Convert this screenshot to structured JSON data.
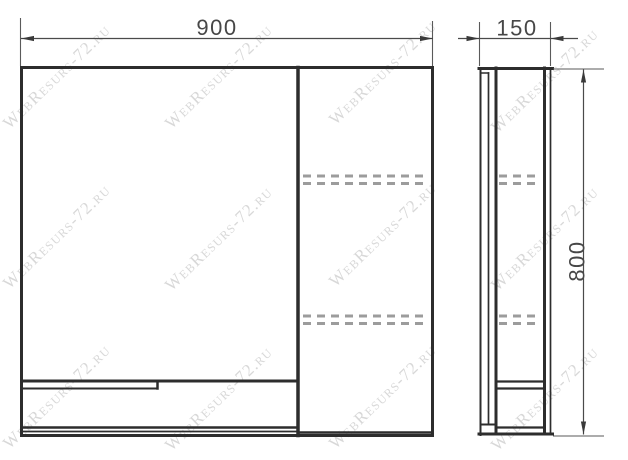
{
  "watermark": {
    "text": "WebResurs-72.ru"
  },
  "dimensions": {
    "width": "900",
    "depth": "150",
    "height": "800"
  }
}
